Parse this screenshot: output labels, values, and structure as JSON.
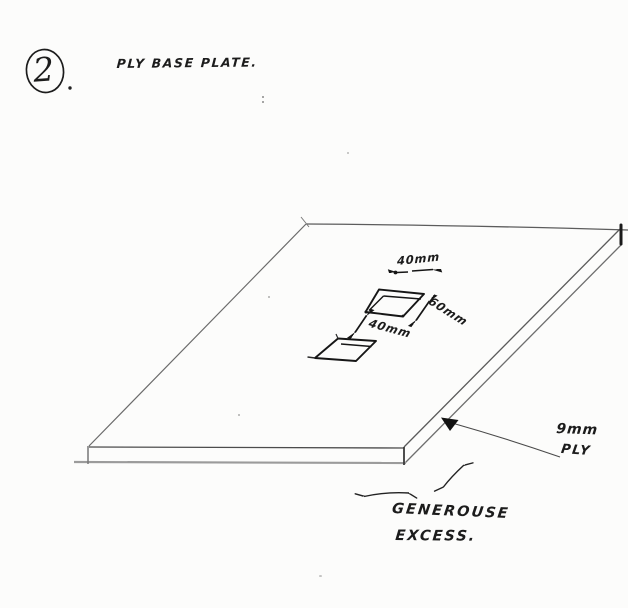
{
  "page": {
    "background_color": "#fcfcfb",
    "ink_color": "#1a1a1a"
  },
  "header": {
    "step_number": "2",
    "step_punctuation": ".",
    "title": "PLY BASE PLATE."
  },
  "diagram": {
    "subject": "plywood base plate isometric sketch with two rectangular cutouts",
    "dimensions": {
      "cutout_width_label": "40mm",
      "cutout_depth_label": "60mm",
      "cutout_spacing_label": "40mm"
    },
    "material": {
      "thickness_label": "9mm",
      "material_label": "PLY"
    },
    "note": {
      "line1": "GENEROUSE",
      "line2": "EXCESS."
    }
  }
}
